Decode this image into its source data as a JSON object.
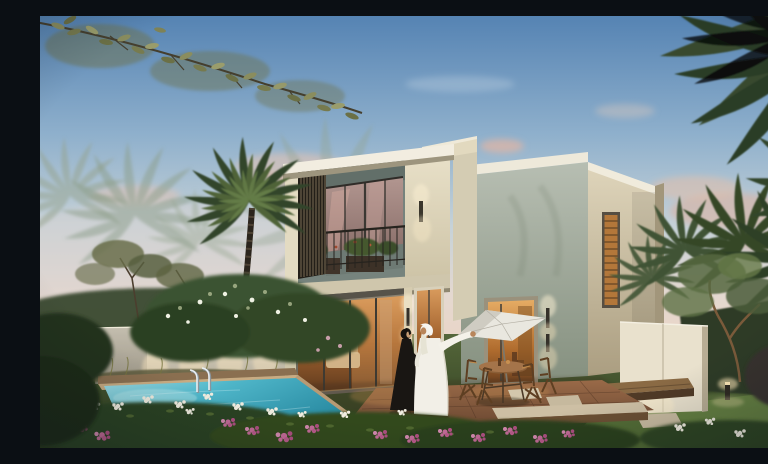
{
  "scene": {
    "title": "Dusk rendering of a modern two-storey villa with pool and palm garden",
    "description": "Twilight exterior rendering of a cream modern villa with a recessed louvered balcony, warm-lit floor-to-ceiling glazing, a turquoise swimming pool with a chrome ladder, flower beds of pink and white blooms, a white patio parasol with wooden folding chairs, palm trees, and an Emirati couple — a man in a white kandura pointing ahead beside a woman in a black abaya — standing on the terracotta terrace.",
    "time_of_day": "dusk",
    "objects": [
      "sky",
      "pink clouds",
      "overhanging branch",
      "palm trees",
      "hazy background palms",
      "modern villa",
      "roof slabs",
      "louver screen",
      "balcony railing",
      "balcony planters",
      "wall sconces",
      "sliding glass doors",
      "slatted window",
      "garden wall",
      "uplights",
      "swimming pool",
      "pool ladder",
      "pool coping",
      "terracotta terrace",
      "stepping stones",
      "benches",
      "bollard light",
      "freestanding wall",
      "white parasol",
      "wooden dining set",
      "man in white kandura",
      "woman in black abaya",
      "blossom tree",
      "flower beds",
      "lawn"
    ]
  },
  "palette": {
    "sky_top": "#5583b3",
    "sky_horizon": "#ecd5c4",
    "cloud_pink": "#eab9a2",
    "villa_cream_lit": "#e9e1c9",
    "villa_cream_shade": "#b8ae92",
    "villa_gray_block": "#9aa496",
    "balcony_recess": "#76837d",
    "louver_wood": "#564c3c",
    "glass_warm_glow": "#c08648",
    "glass_dusk_reflection": "#b7948c",
    "pool_turquoise": "#4fb6c9",
    "coping_tan": "#c8ab82",
    "lawn_green": "#4a6130",
    "flower_pink": "#bd5f8e",
    "flower_white": "#f1ede0",
    "palm_green": "#3c5132",
    "terrace_terracotta": "#8a5a3a",
    "kandura_white": "#f2efe7",
    "abaya_black": "#1a1714",
    "parasol_white": "#e9e7df",
    "sconce_glow": "#ffe9c0"
  }
}
